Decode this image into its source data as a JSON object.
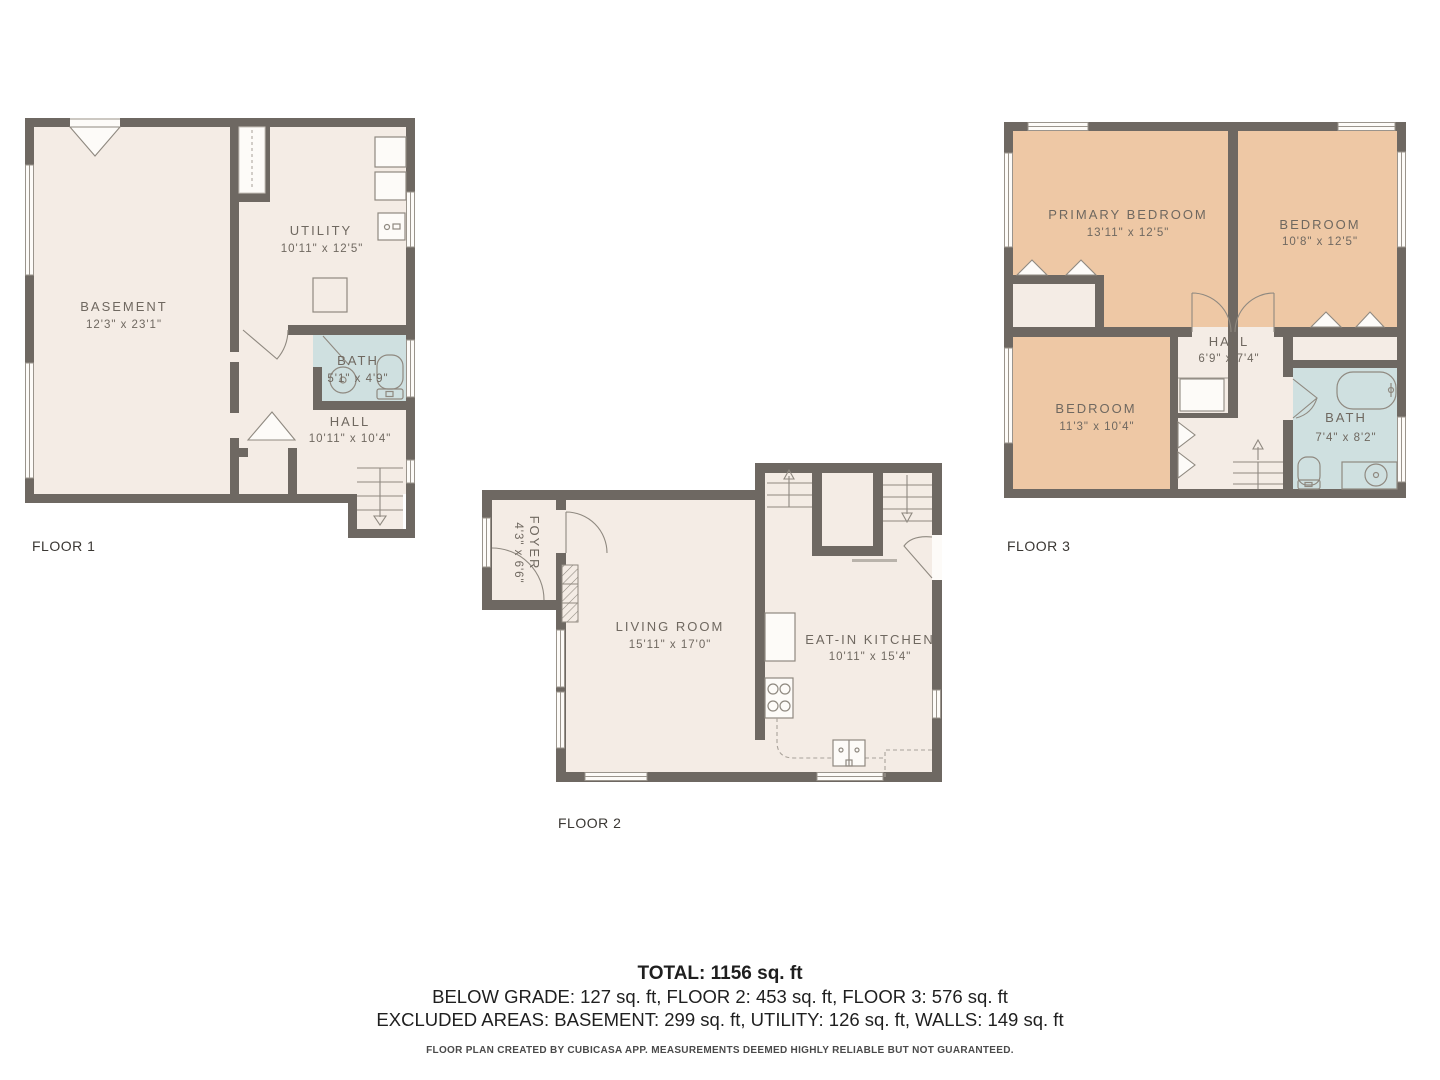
{
  "colors": {
    "wall": "#6e6862",
    "floor": "#f4ece5",
    "bedroom": "#eec8a5",
    "bathroom": "#cfe0e0",
    "room_text": "#6f6860",
    "background": "#ffffff"
  },
  "floors": [
    {
      "label": "FLOOR 1",
      "rooms": [
        {
          "name": "BASEMENT",
          "dims": "12'3\" x 23'1\""
        },
        {
          "name": "UTILITY",
          "dims": "10'11\" x 12'5\""
        },
        {
          "name": "BATH",
          "dims": "5'1\" x 4'9\""
        },
        {
          "name": "HALL",
          "dims": "10'11\" x 10'4\""
        }
      ]
    },
    {
      "label": "FLOOR 2",
      "rooms": [
        {
          "name": "FOYER",
          "dims": "4'3\" x 6'6\""
        },
        {
          "name": "LIVING ROOM",
          "dims": "15'11\" x 17'0\""
        },
        {
          "name": "EAT-IN KITCHEN",
          "dims": "10'11\" x 15'4\""
        }
      ]
    },
    {
      "label": "FLOOR 3",
      "rooms": [
        {
          "name": "PRIMARY BEDROOM",
          "dims": "13'11\" x 12'5\""
        },
        {
          "name": "BEDROOM",
          "dims": "10'8\" x 12'5\""
        },
        {
          "name": "HALL",
          "dims": "6'9\" x 7'4\""
        },
        {
          "name": "BEDROOM",
          "dims": "11'3\" x 10'4\""
        },
        {
          "name": "BATH",
          "dims": "7'4\" x 8'2\""
        }
      ]
    }
  ],
  "summary": {
    "total": "TOTAL: 1156 sq. ft",
    "line2": "BELOW GRADE: 127 sq. ft, FLOOR 2: 453 sq. ft, FLOOR 3: 576 sq. ft",
    "line3": "EXCLUDED AREAS: BASEMENT: 299 sq. ft, UTILITY: 126 sq. ft, WALLS: 149 sq. ft",
    "disclaimer": "FLOOR PLAN CREATED BY CUBICASA APP. MEASUREMENTS DEEMED HIGHLY RELIABLE BUT NOT GUARANTEED."
  }
}
